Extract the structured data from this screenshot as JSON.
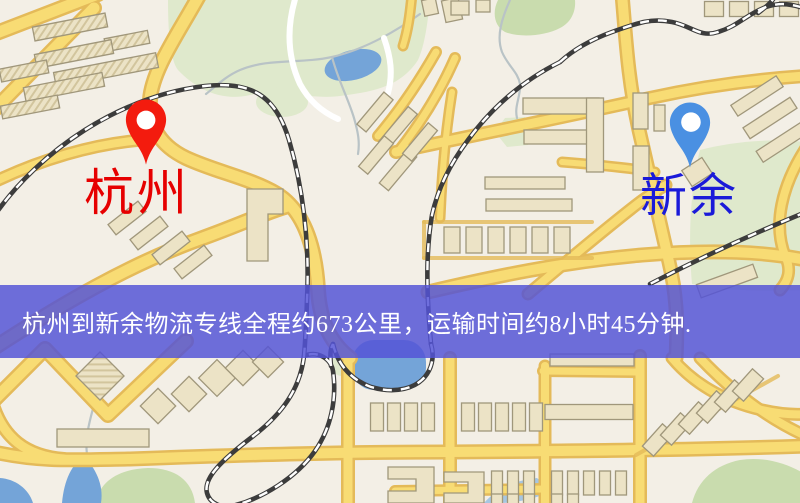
{
  "markers": [
    {
      "id": "origin",
      "label": "杭州",
      "label_color": "#e60000",
      "pin_color": "#f31b0e"
    },
    {
      "id": "destination",
      "label": "新余",
      "label_color": "#1a1ad9",
      "pin_color": "#4a90e2"
    }
  ],
  "banner": {
    "text": "杭州到新余物流专线全程约673公里，运输时间约8小时45分钟.",
    "background": "rgba(84,84,214,0.84)",
    "text_color": "#ffffff"
  },
  "map_colors": {
    "background": "#f3efe6",
    "park": "#dfe9cc",
    "park_dark": "#c9dcae",
    "water": "#74a4d8",
    "water_light": "#a6c6e2",
    "stream": "#b9c3c6",
    "minor_road": "#ffffff",
    "road_fill": "#f8dc74",
    "road_casing": "#e4ba59",
    "railway": "#3c3c3c",
    "building_fill": "#ece3c6",
    "building_stroke": "#a0977b"
  }
}
